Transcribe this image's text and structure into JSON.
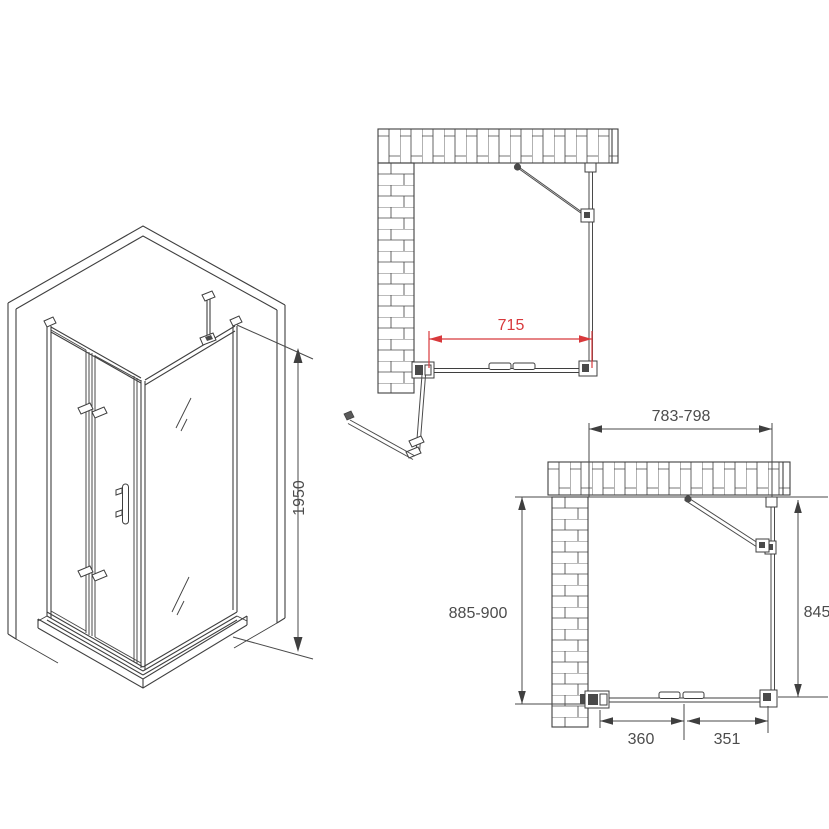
{
  "title": "Corner shower enclosure with bi-fold door - installation drawing",
  "colors": {
    "background": "#ffffff",
    "line": "#3f3f3f",
    "dimension_text": "#4c4c4c",
    "accent_red": "#d8393c"
  },
  "iso_view": {
    "description": "3D view of corner shower enclosure",
    "height_label": "1950"
  },
  "plan_open": {
    "description": "Top view, bi-fold door open",
    "width_label": "715"
  },
  "plan_closed": {
    "description": "Top view, door closed",
    "top_width_label": "783-798",
    "left_height_label": "885-900",
    "right_height_label": "845",
    "bottom_left_label": "360",
    "bottom_right_label": "351"
  }
}
